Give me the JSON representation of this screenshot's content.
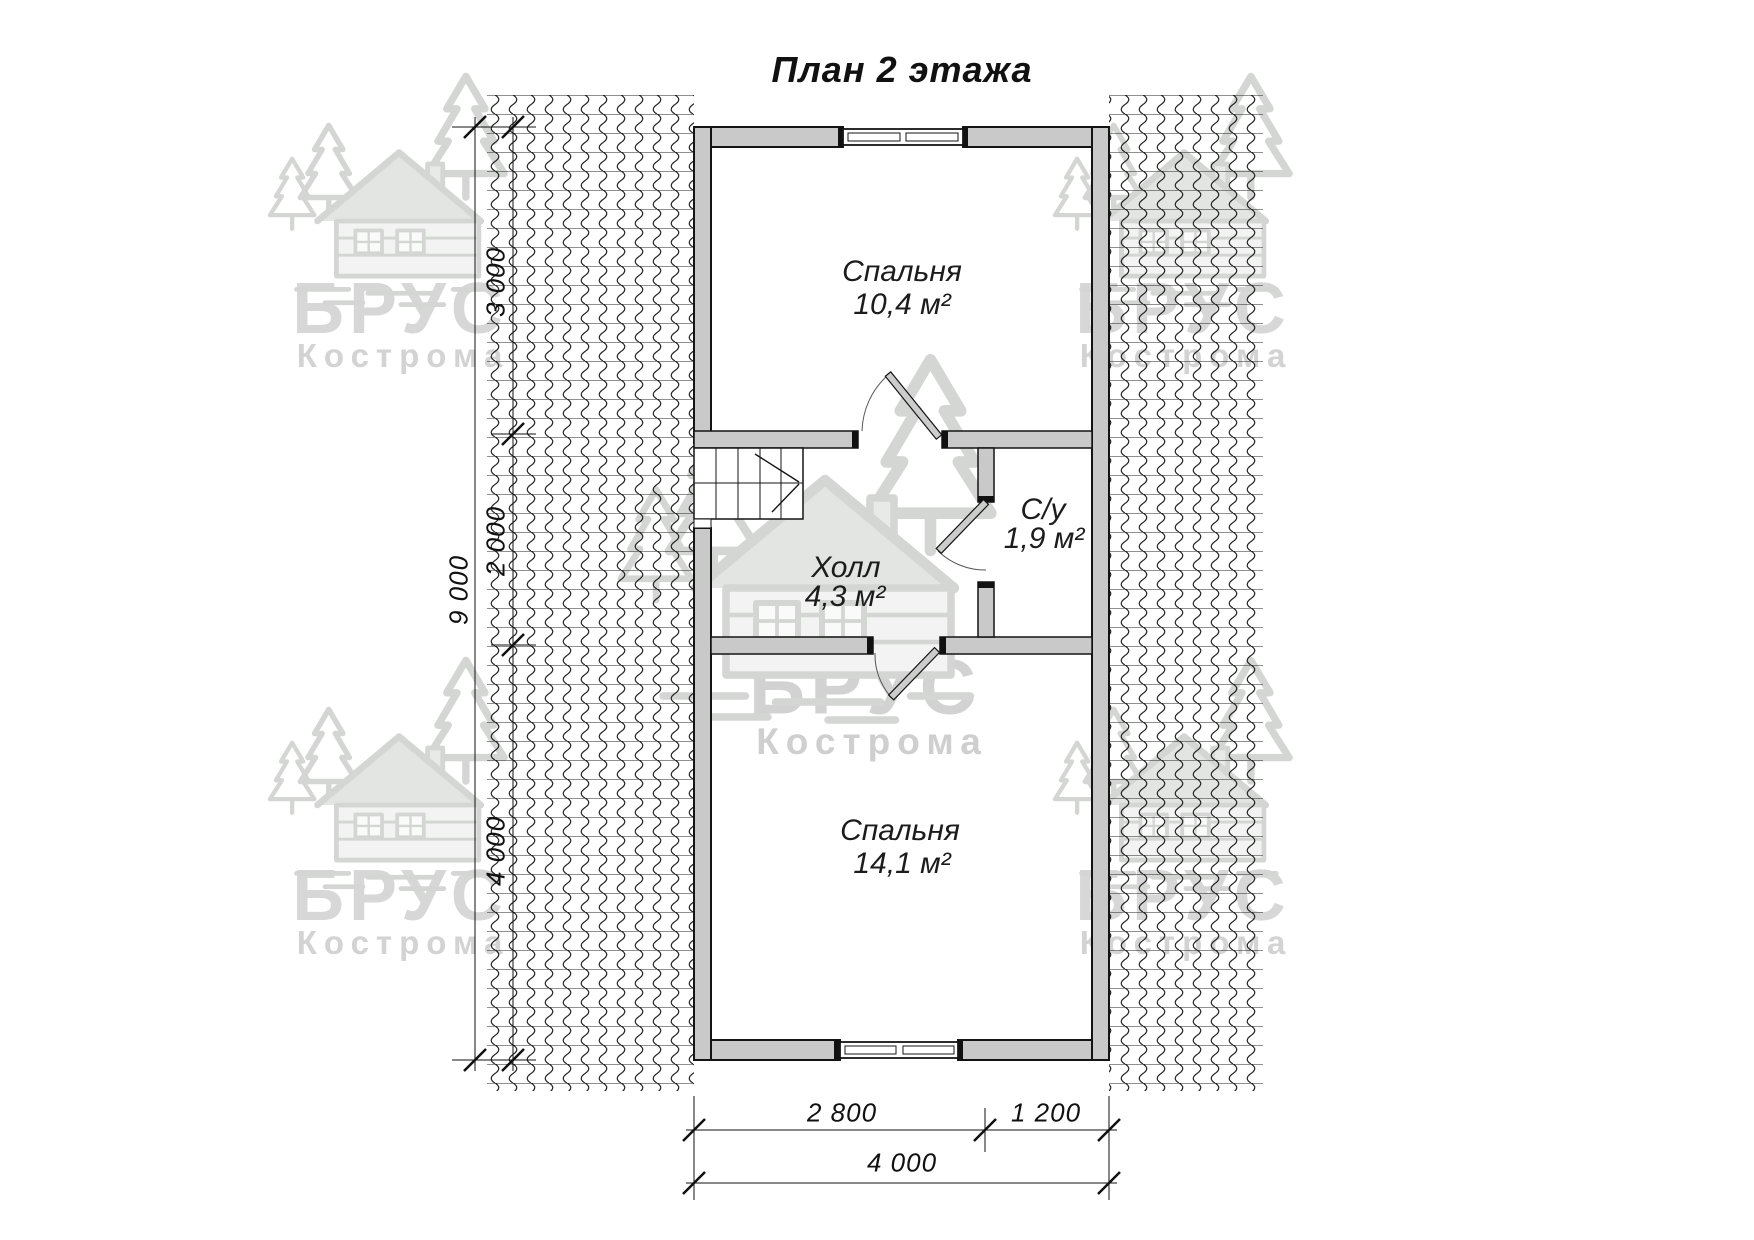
{
  "title": "План 2 этажа",
  "watermark": {
    "brand": "БРУС",
    "city": "Кострома"
  },
  "rooms": [
    {
      "name": "Спальня",
      "area": "10,4 м²"
    },
    {
      "name": "С/у",
      "area": "1,9 м²"
    },
    {
      "name": "Холл",
      "area": "4,3 м²"
    },
    {
      "name": "Спальня",
      "area": "14,1 м²"
    }
  ],
  "dimensions": {
    "left_total": "9 000",
    "left_segments": [
      "3 000",
      "2 000",
      "4 000"
    ],
    "bottom_segments": [
      "2 800",
      "1 200"
    ],
    "bottom_total": "4 000"
  },
  "colors": {
    "wall_fill": "#c9c9c9",
    "line": "#1a1a1a",
    "watermark": "#d6d6d6"
  }
}
